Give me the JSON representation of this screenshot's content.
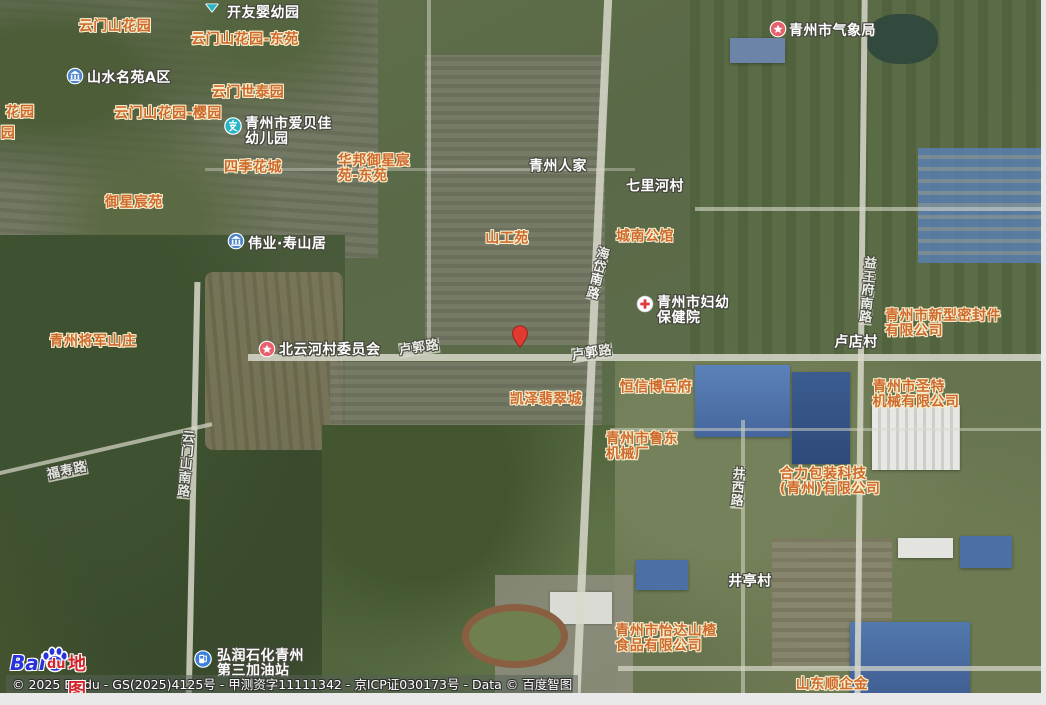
{
  "map": {
    "colors": {
      "estate_label_text": "#cf6a2e",
      "estate_label_outline": "#f8eecb",
      "place_label_text": "#ffffff",
      "place_label_outline": "#44453c",
      "pin_red": "#e13a31",
      "road_line": "#d8d8ca"
    },
    "marker": {
      "x": 520,
      "y": 352
    },
    "labels": [
      {
        "id": "yunmenshan-huayuan",
        "type": "estate",
        "lines": [
          "云门山花园"
        ],
        "x": 115,
        "y": 27
      },
      {
        "id": "yunmenshan-huayuan-dongyuan",
        "type": "estate",
        "lines": [
          "云门山花园-东苑"
        ],
        "x": 245,
        "y": 40
      },
      {
        "id": "yunmen-shitaiyuan",
        "type": "estate",
        "lines": [
          "云门世泰园"
        ],
        "x": 248,
        "y": 93
      },
      {
        "id": "yunmenshan-huayuan-yingyuan",
        "type": "estate",
        "lines": [
          "云门山花园-樱园"
        ],
        "x": 168,
        "y": 114
      },
      {
        "id": "partial-huayuan",
        "type": "estate",
        "lines": [
          "花园"
        ],
        "x": 20,
        "y": 113
      },
      {
        "id": "partial-yuan",
        "type": "estate",
        "lines": [
          "园"
        ],
        "x": 8,
        "y": 134
      },
      {
        "id": "siji-huacheng",
        "type": "estate",
        "lines": [
          "四季花城"
        ],
        "x": 253,
        "y": 168
      },
      {
        "id": "huabang-yuxingchenyuan-dongyuan",
        "type": "estate",
        "lines": [
          "华邦御星宸",
          "苑-东苑"
        ],
        "x": 374,
        "y": 169
      },
      {
        "id": "yuxing-chenyuan",
        "type": "estate",
        "lines": [
          "御星宸苑"
        ],
        "x": 134,
        "y": 203
      },
      {
        "id": "shangong-yuan",
        "type": "estate",
        "lines": [
          "山工苑"
        ],
        "x": 507,
        "y": 239
      },
      {
        "id": "chengnan-gongguan",
        "type": "estate",
        "lines": [
          "城南公馆"
        ],
        "x": 645,
        "y": 237
      },
      {
        "id": "qingzhou-jiangjun-shanzhuang",
        "type": "estate",
        "lines": [
          "青州将军山庄"
        ],
        "x": 93,
        "y": 342
      },
      {
        "id": "kaize-feicuicheng",
        "type": "estate",
        "lines": [
          "凯泽翡翠城"
        ],
        "x": 546,
        "y": 400
      },
      {
        "id": "hengxin-boyuefu",
        "type": "estate",
        "lines": [
          "恒信博岳府"
        ],
        "x": 656,
        "y": 388
      },
      {
        "id": "qingzhou-ludong-jixiechang",
        "type": "estate",
        "lines": [
          "青州市鲁东",
          "机械厂"
        ],
        "x": 642,
        "y": 447
      },
      {
        "id": "xinxing-mifengjian-gongsi",
        "type": "estate",
        "lines": [
          "青州市新型密封件",
          "有限公司"
        ],
        "x": 943,
        "y": 324
      },
      {
        "id": "shengte-jixie-gongsi",
        "type": "estate",
        "lines": [
          "青州市圣特",
          "机械有限公司"
        ],
        "x": 916,
        "y": 395
      },
      {
        "id": "heli-baozhuang-gongsi",
        "type": "estate",
        "lines": [
          "合力包装科技",
          "(青州)有限公司"
        ],
        "x": 830,
        "y": 482
      },
      {
        "id": "yida-shanzha-gongsi",
        "type": "estate",
        "lines": [
          "青州市怡达山楂",
          "食品有限公司"
        ],
        "x": 666,
        "y": 639
      },
      {
        "id": "shandong-shunqijin",
        "type": "estate",
        "lines": [
          "山东顺企金"
        ],
        "x": 832,
        "y": 685
      },
      {
        "id": "kaiyou-yingyouyuan",
        "type": "place",
        "anchor": "topleft",
        "lines": [
          "开友婴幼园"
        ],
        "x": 227,
        "y": 6,
        "icon": {
          "name": "callout-tip-icon",
          "x": 212,
          "y": 7
        }
      },
      {
        "id": "shanshui-mingyuan-aqu",
        "type": "place",
        "anchor": "topleft",
        "lines": [
          "山水名苑A区"
        ],
        "x": 87,
        "y": 71,
        "icon": {
          "name": "estate-icon",
          "x": 75,
          "y": 78
        }
      },
      {
        "id": "aibeijia-youeryuan",
        "type": "place",
        "anchor": "topleft",
        "lines": [
          "青州市爱贝佳",
          "幼儿园"
        ],
        "x": 245,
        "y": 117,
        "icon": {
          "name": "kindergarten-icon",
          "x": 233,
          "y": 128
        }
      },
      {
        "id": "qingzhou-renjia",
        "type": "place",
        "lines": [
          "青州人家"
        ],
        "x": 558,
        "y": 167
      },
      {
        "id": "qilihe-cun",
        "type": "place",
        "lines": [
          "七里河村"
        ],
        "x": 655,
        "y": 187
      },
      {
        "id": "qingzhou-qixiangju",
        "type": "place",
        "anchor": "topleft",
        "lines": [
          "青州市气象局"
        ],
        "x": 789,
        "y": 24,
        "icon": {
          "name": "star-icon",
          "x": 778,
          "y": 31
        }
      },
      {
        "id": "weiye-shoushanju",
        "type": "place",
        "anchor": "topleft",
        "lines": [
          "伟业·寿山居"
        ],
        "x": 248,
        "y": 237,
        "icon": {
          "name": "estate-icon",
          "x": 236,
          "y": 243
        }
      },
      {
        "id": "fuyou-baojianyuan",
        "type": "place",
        "anchor": "topleft",
        "lines": [
          "青州市妇幼",
          "保健院"
        ],
        "x": 657,
        "y": 296,
        "icon": {
          "name": "hospital-icon",
          "x": 645,
          "y": 306
        }
      },
      {
        "id": "beiyunhecun-weiyuanhui",
        "type": "place",
        "anchor": "topleft",
        "lines": [
          "北云河村委员会"
        ],
        "x": 279,
        "y": 343,
        "icon": {
          "name": "star-icon",
          "x": 267,
          "y": 351
        }
      },
      {
        "id": "ludian-cun",
        "type": "place",
        "lines": [
          "卢店村"
        ],
        "x": 856,
        "y": 343
      },
      {
        "id": "jingting-cun",
        "type": "place",
        "lines": [
          "井亭村"
        ],
        "x": 750,
        "y": 582
      },
      {
        "id": "hongrun-jiayouzhan",
        "type": "place",
        "anchor": "topleft",
        "lines": [
          "弘润石化青州",
          "第三加油站"
        ],
        "x": 217,
        "y": 649,
        "icon": {
          "name": "gas-icon",
          "x": 203,
          "y": 661
        }
      },
      {
        "id": "lugou-lu-west",
        "type": "road",
        "lines": [
          "卢郭路"
        ],
        "x": 419,
        "y": 348,
        "rotate": -8
      },
      {
        "id": "lugou-lu-east",
        "type": "road",
        "lines": [
          "卢郭路"
        ],
        "x": 592,
        "y": 353,
        "rotate": -8
      },
      {
        "id": "fushou-lu",
        "type": "road",
        "lines": [
          "福寿路"
        ],
        "x": 67,
        "y": 471,
        "rotate": -12
      },
      {
        "id": "yunmenshan-nanlu",
        "type": "road",
        "vertical": true,
        "lines": [
          "云",
          "门",
          "山",
          "南",
          "路"
        ],
        "x": 186,
        "y": 465,
        "rotate": 5
      },
      {
        "id": "haidai-nanlu",
        "type": "road",
        "vertical": true,
        "lines": [
          "海",
          "岱",
          "南",
          "路"
        ],
        "x": 598,
        "y": 274,
        "rotate": 14
      },
      {
        "id": "yiwangfu-nanlu",
        "type": "road",
        "vertical": true,
        "lines": [
          "益",
          "王",
          "府",
          "南",
          "路"
        ],
        "x": 868,
        "y": 291,
        "rotate": 5
      },
      {
        "id": "jingxi-lu",
        "type": "road",
        "vertical": true,
        "lines": [
          "井",
          "西",
          "路"
        ],
        "x": 738,
        "y": 488,
        "rotate": 4
      }
    ],
    "attribution": {
      "logo_bai": "Bai",
      "logo_du": "du",
      "logo_suffix": "地图",
      "copyright": "© 2025 Baidu - GS(2025)4125号 - 甲测资字11111342 - 京ICP证030173号 - Data © 百度智图"
    }
  }
}
